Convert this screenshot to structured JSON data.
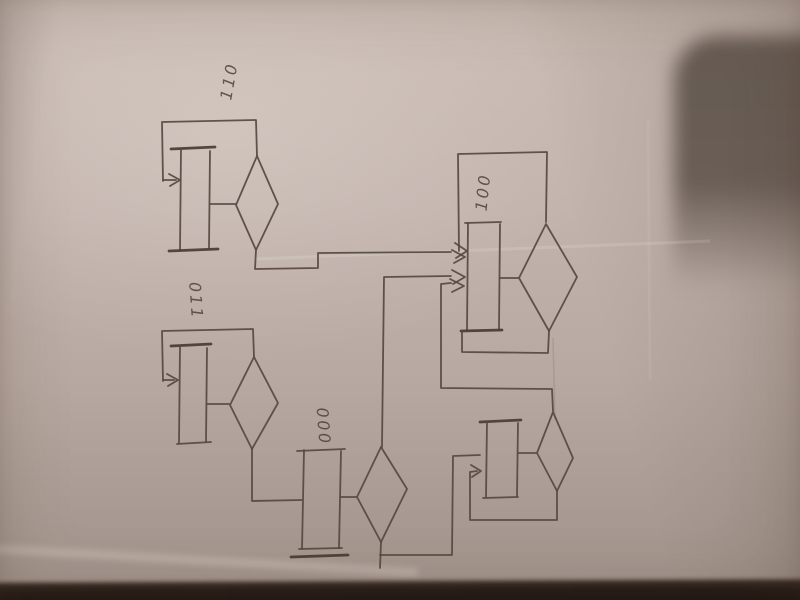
{
  "scene": {
    "type": "photo of a hand-drawn flowchart / state-diagram sketch on paper, rotated 90 degrees",
    "states": [
      {
        "label": "110"
      },
      {
        "label": "011"
      },
      {
        "label": "000"
      },
      {
        "label": "100"
      },
      {
        "label": ""
      }
    ],
    "connections": [
      "110 diamond -> 100 box",
      "011 diamond -> 000 box",
      "000 diamond top -> 100 box",
      "000 diamond bottom -> unlabeled box",
      "unlabeled diamond top -> 100 box",
      "feedback loops on 110, 011, 100 and unlabeled blocks"
    ],
    "colors": {
      "paper": "#bdafa7",
      "ink": "#564940",
      "dark_object": "#635850",
      "bottom_shadow": "#231b16"
    }
  }
}
